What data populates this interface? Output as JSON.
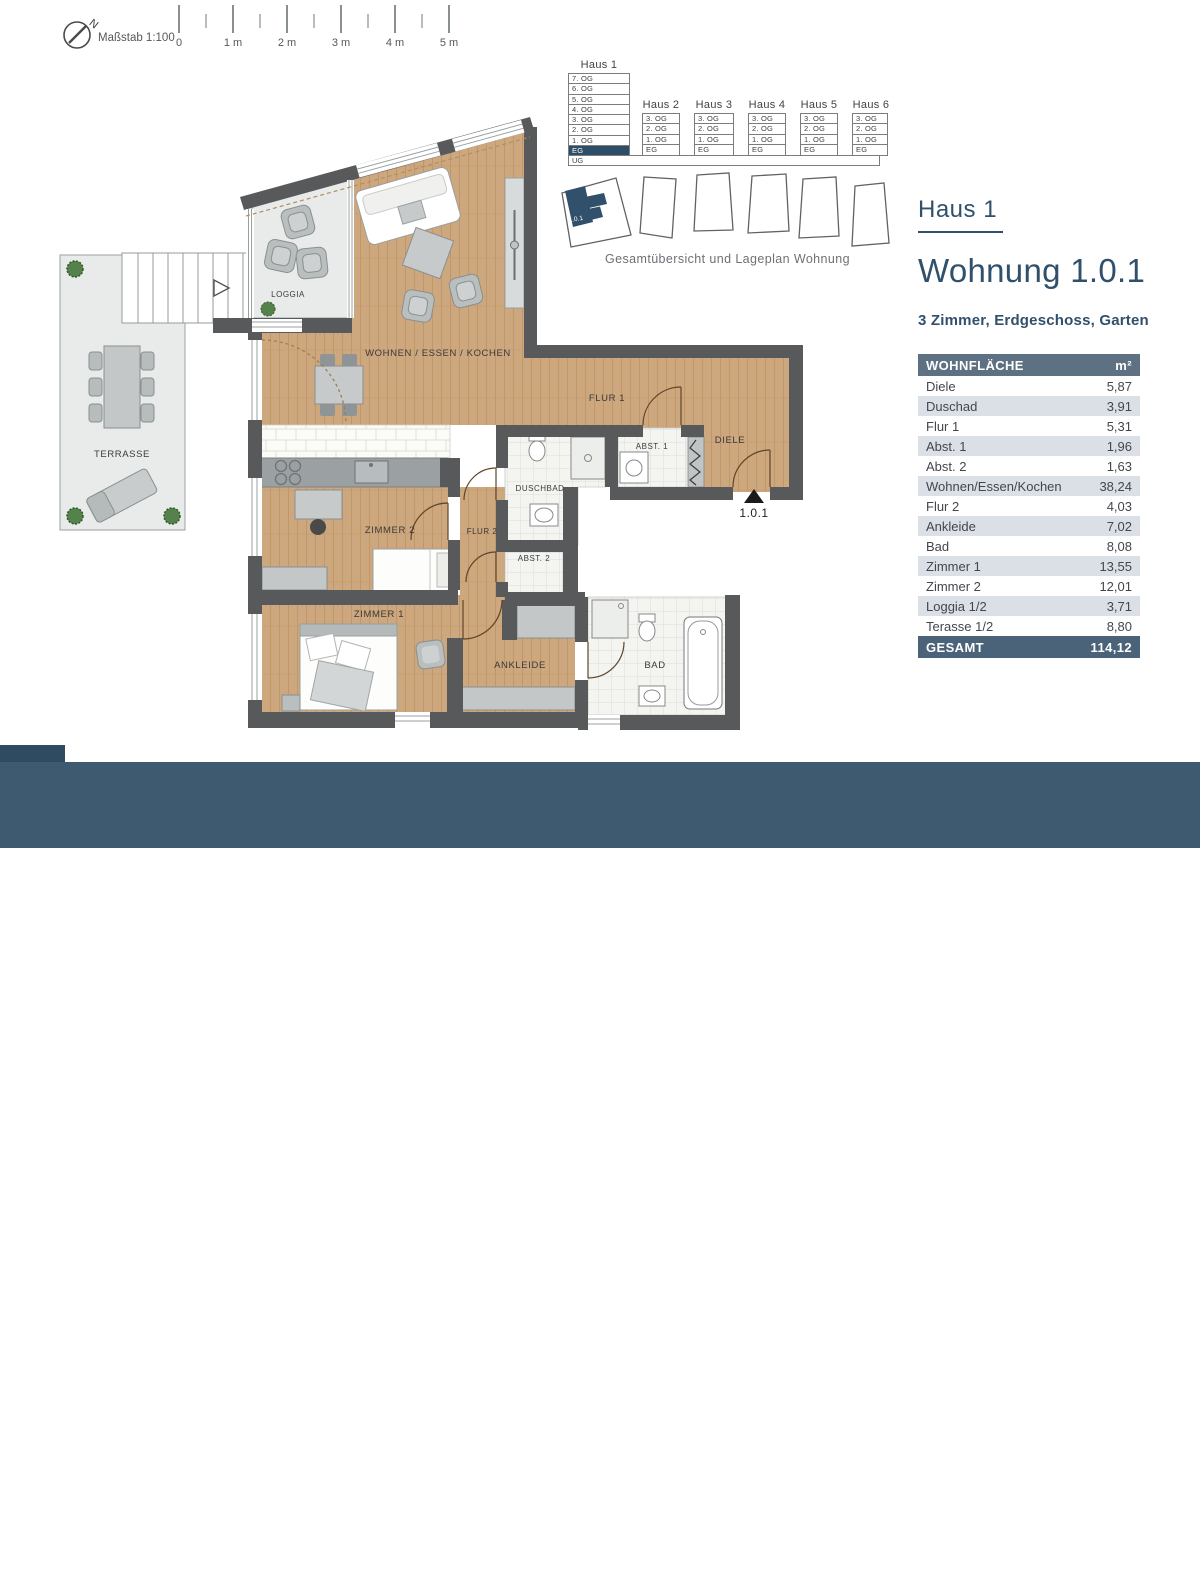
{
  "scalebar": {
    "caption": "Maßstab 1:100",
    "labels": [
      "0",
      "1 m",
      "2 m",
      "3 m",
      "4 m",
      "5 m"
    ],
    "north": "N"
  },
  "overview": {
    "haus1": {
      "label": "Haus 1",
      "floors": [
        "7. OG",
        "6. OG",
        "5. OG",
        "4. OG",
        "3. OG",
        "2. OG",
        "1. OG",
        "EG"
      ],
      "selected_floor": "EG"
    },
    "basement": "UG",
    "houses": [
      {
        "label": "Haus 2",
        "floors": [
          "3. OG",
          "2. OG",
          "1. OG",
          "EG"
        ]
      },
      {
        "label": "Haus 3",
        "floors": [
          "3. OG",
          "2. OG",
          "1. OG",
          "EG"
        ]
      },
      {
        "label": "Haus 4",
        "floors": [
          "3. OG",
          "2. OG",
          "1. OG",
          "EG"
        ]
      },
      {
        "label": "Haus 5",
        "floors": [
          "3. OG",
          "2. OG",
          "1. OG",
          "EG"
        ]
      },
      {
        "label": "Haus 6",
        "floors": [
          "3. OG",
          "2. OG",
          "1. OG",
          "EG"
        ]
      }
    ],
    "caption": "Gesamtübersicht und Lageplan Wohnung",
    "unit_marker": "1.0.1"
  },
  "panel": {
    "house": "Haus 1",
    "unit": "Wohnung 1.0.1",
    "subtitle": "3 Zimmer, Erdgeschoss, Garten",
    "table": {
      "header": "WOHNFLÄCHE",
      "unit_header": "m²",
      "rows": [
        {
          "label": "Diele",
          "value": "5,87"
        },
        {
          "label": "Duschad",
          "value": "3,91"
        },
        {
          "label": "Flur 1",
          "value": "5,31"
        },
        {
          "label": "Abst. 1",
          "value": "1,96"
        },
        {
          "label": "Abst. 2",
          "value": "1,63"
        },
        {
          "label": "Wohnen/Essen/Kochen",
          "value": "38,24"
        },
        {
          "label": "Flur 2",
          "value": "4,03"
        },
        {
          "label": "Ankleide",
          "value": "7,02"
        },
        {
          "label": "Bad",
          "value": "8,08"
        },
        {
          "label": "Zimmer 1",
          "value": "13,55"
        },
        {
          "label": "Zimmer 2",
          "value": "12,01"
        },
        {
          "label": "Loggia 1/2",
          "value": "3,71"
        },
        {
          "label": "Terasse 1/2",
          "value": "8,80"
        }
      ],
      "total_label": "GESAMT",
      "total_value": "114,12"
    }
  },
  "plan": {
    "labels": {
      "wohnen": "WOHNEN / ESSEN / KOCHEN",
      "flur1": "FLUR 1",
      "abst1": "ABST. 1",
      "diele": "DIELE",
      "duschbad": "DUSCHBAD",
      "flur2": "FLUR 2",
      "abst2": "ABST. 2",
      "zimmer1": "ZIMMER 1",
      "zimmer2": "ZIMMER 2",
      "ankleide": "ANKLEIDE",
      "bad": "BAD",
      "loggia": "LOGGIA",
      "terrasse": "TERRASSE"
    },
    "entrance": "1.0.1"
  },
  "footer": {
    "brand_bold": "Art",
    "brand_rest": "em",
    "project": "– STADTQUARTIER OBERURSEL",
    "logo": "WILMA"
  },
  "colors": {
    "accent": "#31506b",
    "footer": "#3e5a70",
    "table_header": "#5d7183",
    "table_total": "#4a6379",
    "row_alt": "#dbdfe6",
    "selected_floor": "#2e4d66",
    "wall": "#58595b",
    "wood": "#cda77d",
    "outdoor": "#e9ebeb"
  }
}
